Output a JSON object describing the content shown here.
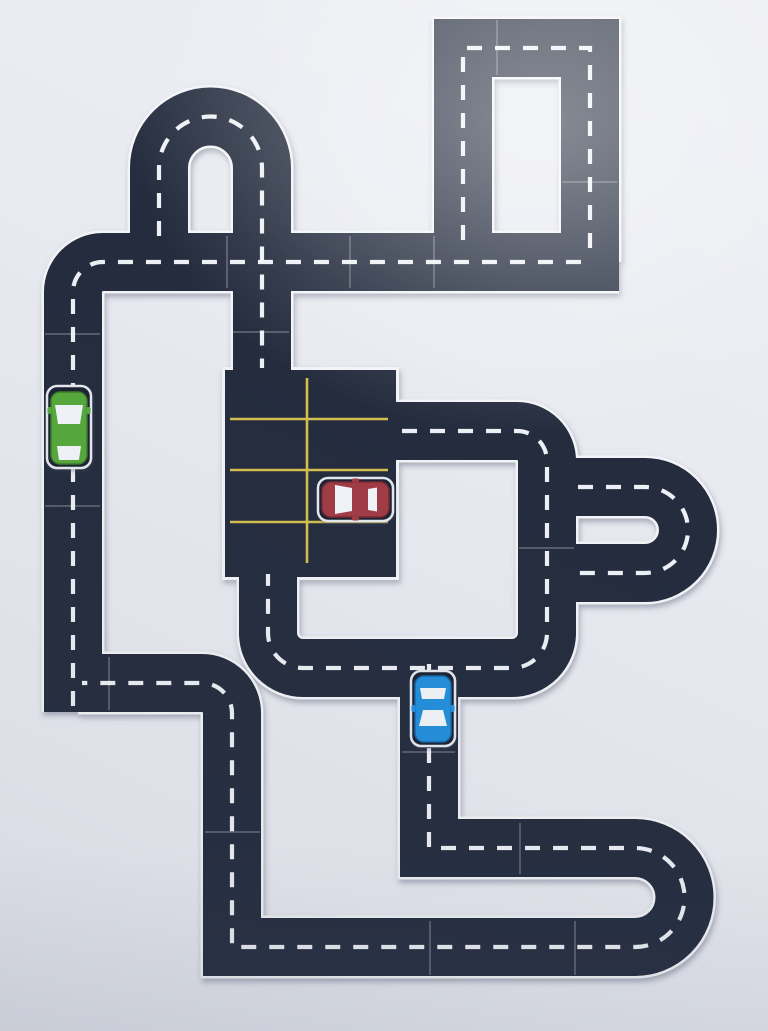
{
  "scene": {
    "description": "Overhead photo of a toy road track assembled from laminated printable road pieces on a light table. Dark asphalt-style pieces with white dashed center lines form loops, U-turns and junctions around a central parking lot piece with yellow bay markings. Three paper toy cars are placed on the track: a green car, a red car and a blue car.",
    "background_color": "#e9ebf1",
    "road_color": "#242c3e",
    "road_edge_color": "#f4f5f8",
    "dash_color": "#eef1f5",
    "seam_color": "#ffffff"
  },
  "track": {
    "sections": [
      {
        "name": "top-left u-turn",
        "type": "U-turn arch piece standing on the top road"
      },
      {
        "name": "top road",
        "type": "horizontal straights with a rounded corner down to the left road"
      },
      {
        "name": "top-right loop",
        "type": "closed rectangle of straight pieces with square corners"
      },
      {
        "name": "left road",
        "type": "vertical straights carrying the green car, joining the bottom-left route"
      },
      {
        "name": "parking lot",
        "type": "large lot piece with yellow bay lines, entrances top and bottom"
      },
      {
        "name": "middle loop",
        "type": "rounded-corner loop running right of the parking lot"
      },
      {
        "name": "right sideways u-turn",
        "type": "U-turn opening left, attached to the middle loop"
      },
      {
        "name": "center branch",
        "type": "vertical branch carrying the blue car down from the middle loop"
      },
      {
        "name": "bottom-right u-turn",
        "type": "U-turn opening left joining the two bottom roads"
      },
      {
        "name": "bottom road",
        "type": "horizontal straights with square corners returning to the left road"
      }
    ]
  },
  "parking_lot": {
    "line_color": "#d6c04e",
    "horizontal_lines": 3,
    "vertical_lines": 1,
    "occupied_by": "red car"
  },
  "cars": [
    {
      "name": "green car",
      "body_color": "#57a93c",
      "outline_color": "#3c7d27",
      "window_color": "#f3f6f9",
      "card_color": "#1b2232",
      "facing": "up",
      "location": "left vertical road"
    },
    {
      "name": "red car",
      "body_color": "#a23b44",
      "outline_color": "#7c2b33",
      "window_color": "#f3f6f9",
      "card_color": "#1b2232",
      "facing": "left",
      "location": "parking lot bay"
    },
    {
      "name": "blue car",
      "body_color": "#2090dc",
      "outline_color": "#1468a8",
      "window_color": "#f3f6f9",
      "card_color": "#1b2232",
      "facing": "down",
      "location": "center branch road"
    }
  ]
}
